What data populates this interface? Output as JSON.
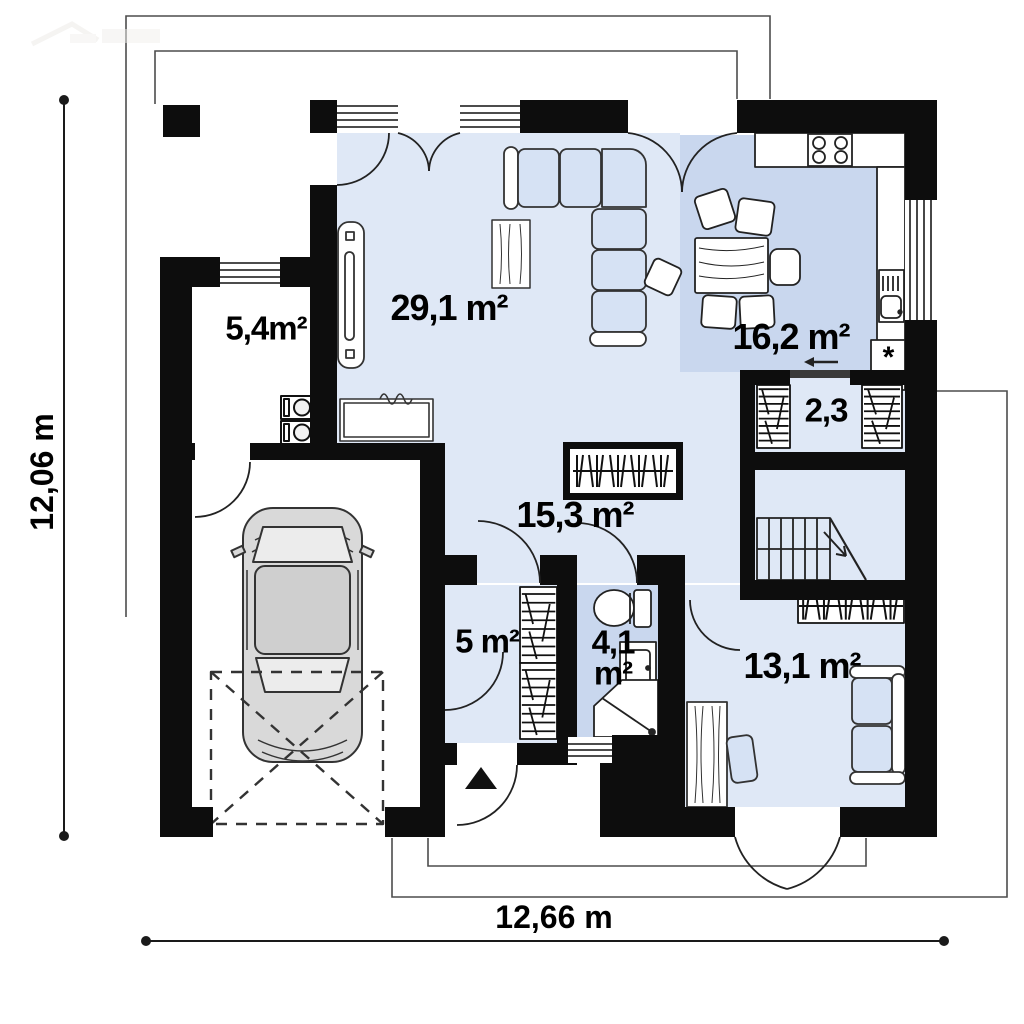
{
  "plan": {
    "rooms": [
      {
        "id": "utility_room",
        "area_label": "5,4m²"
      },
      {
        "id": "living_room",
        "area_label": "29,1 m²"
      },
      {
        "id": "kitchen",
        "area_label": "16,2 m²"
      },
      {
        "id": "pantry",
        "area_label": "2,3"
      },
      {
        "id": "hall",
        "area_label": "15,3 m²"
      },
      {
        "id": "vestibule",
        "area_label": "5 m²"
      },
      {
        "id": "bathroom",
        "area_label_line1": "4,1",
        "area_label_line2": "m²"
      },
      {
        "id": "bedroom",
        "area_label": "13,1 m²"
      }
    ],
    "dimensions": {
      "height_label": "12,06 m",
      "width_label": "12,66 m"
    },
    "symbols": {
      "fridge": "*"
    },
    "colors": {
      "wall": "#0d0d0d",
      "floor_light": "#dfe8f6",
      "floor_dark": "#c9d7ee",
      "furniture_fill": "#d6e2f4"
    }
  }
}
